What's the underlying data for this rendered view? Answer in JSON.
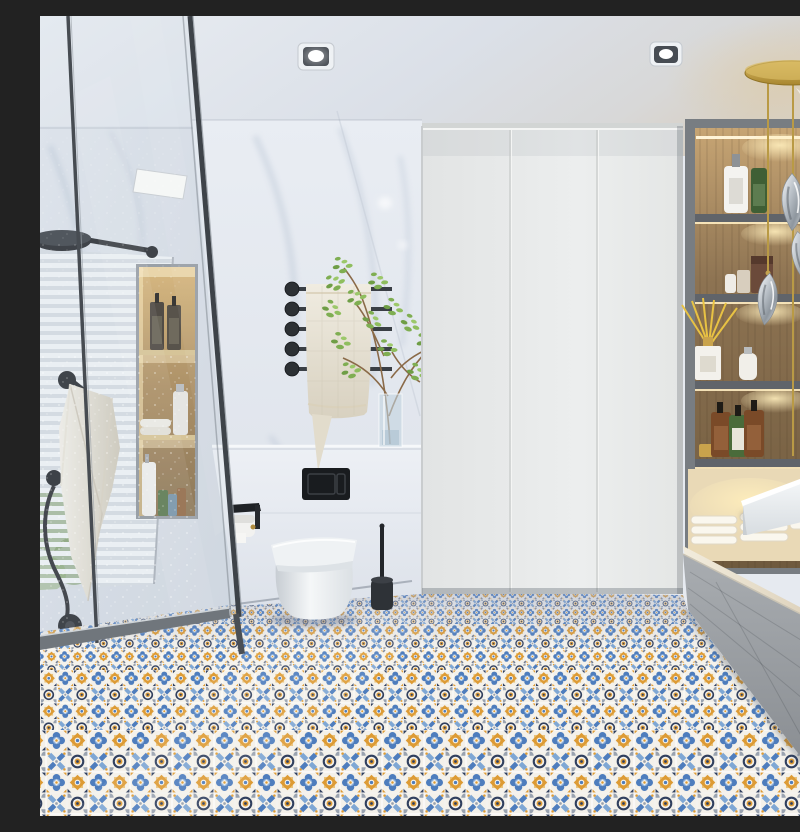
{
  "scene": {
    "type": "photorealistic-interior-render",
    "room": "modern bathroom",
    "description": "Modern bathroom render: walk-in glass shower with black rain head, hand shower and backlit marble niche on the left; window with white blinds; marble wall with black towel rack, cream towel, green plant in glass vase; wall-hung white toilet with black flush plate, paper holder and brush; white wardrobe cabinet; warm backlit wooden shelving with toiletry bottles and reed diffuser; gold pendant with chrome drop lights; floating white marble vanity slab over a grey bench with folded towels; patchwork Moroccan patterned tile floor in blue, orange, navy and white.",
    "objects": [
      "glass-shower-enclosure",
      "rain-shower-head",
      "hand-shower",
      "shower-mixer-valve",
      "window-blinds",
      "hanging-towel",
      "shower-niche-shelves",
      "toiletry-bottles",
      "recessed-downlights",
      "towel-rack",
      "bath-towel",
      "plant-in-glass-vase",
      "wall-hung-toilet",
      "flush-plate",
      "toilet-paper-holder",
      "toilet-brush",
      "white-wardrobe-cabinet",
      "wood-display-shelves",
      "reed-diffuser",
      "folded-towels",
      "bench-cabinet",
      "marble-vanity-counter",
      "gold-pendant-chrome-drops",
      "patterned-tile-floor",
      "linear-shower-drain"
    ],
    "palette": {
      "ceiling": "#dfe3ea",
      "marble": "#e8ecf2",
      "cabinet": "#e9ebea",
      "wood": "#8d7354",
      "warm_glow": "#f0d9a8",
      "gold": "#c0a050",
      "chrome": "#c7ccd2",
      "fixture_black": "#26292d",
      "tile_blue": "#4e7dbd",
      "tile_light_blue": "#8fb0d8",
      "tile_orange": "#dd9b35",
      "tile_navy": "#31405f",
      "tile_gray": "#9aa3b0",
      "tile_background": "#f4f2ec"
    }
  }
}
